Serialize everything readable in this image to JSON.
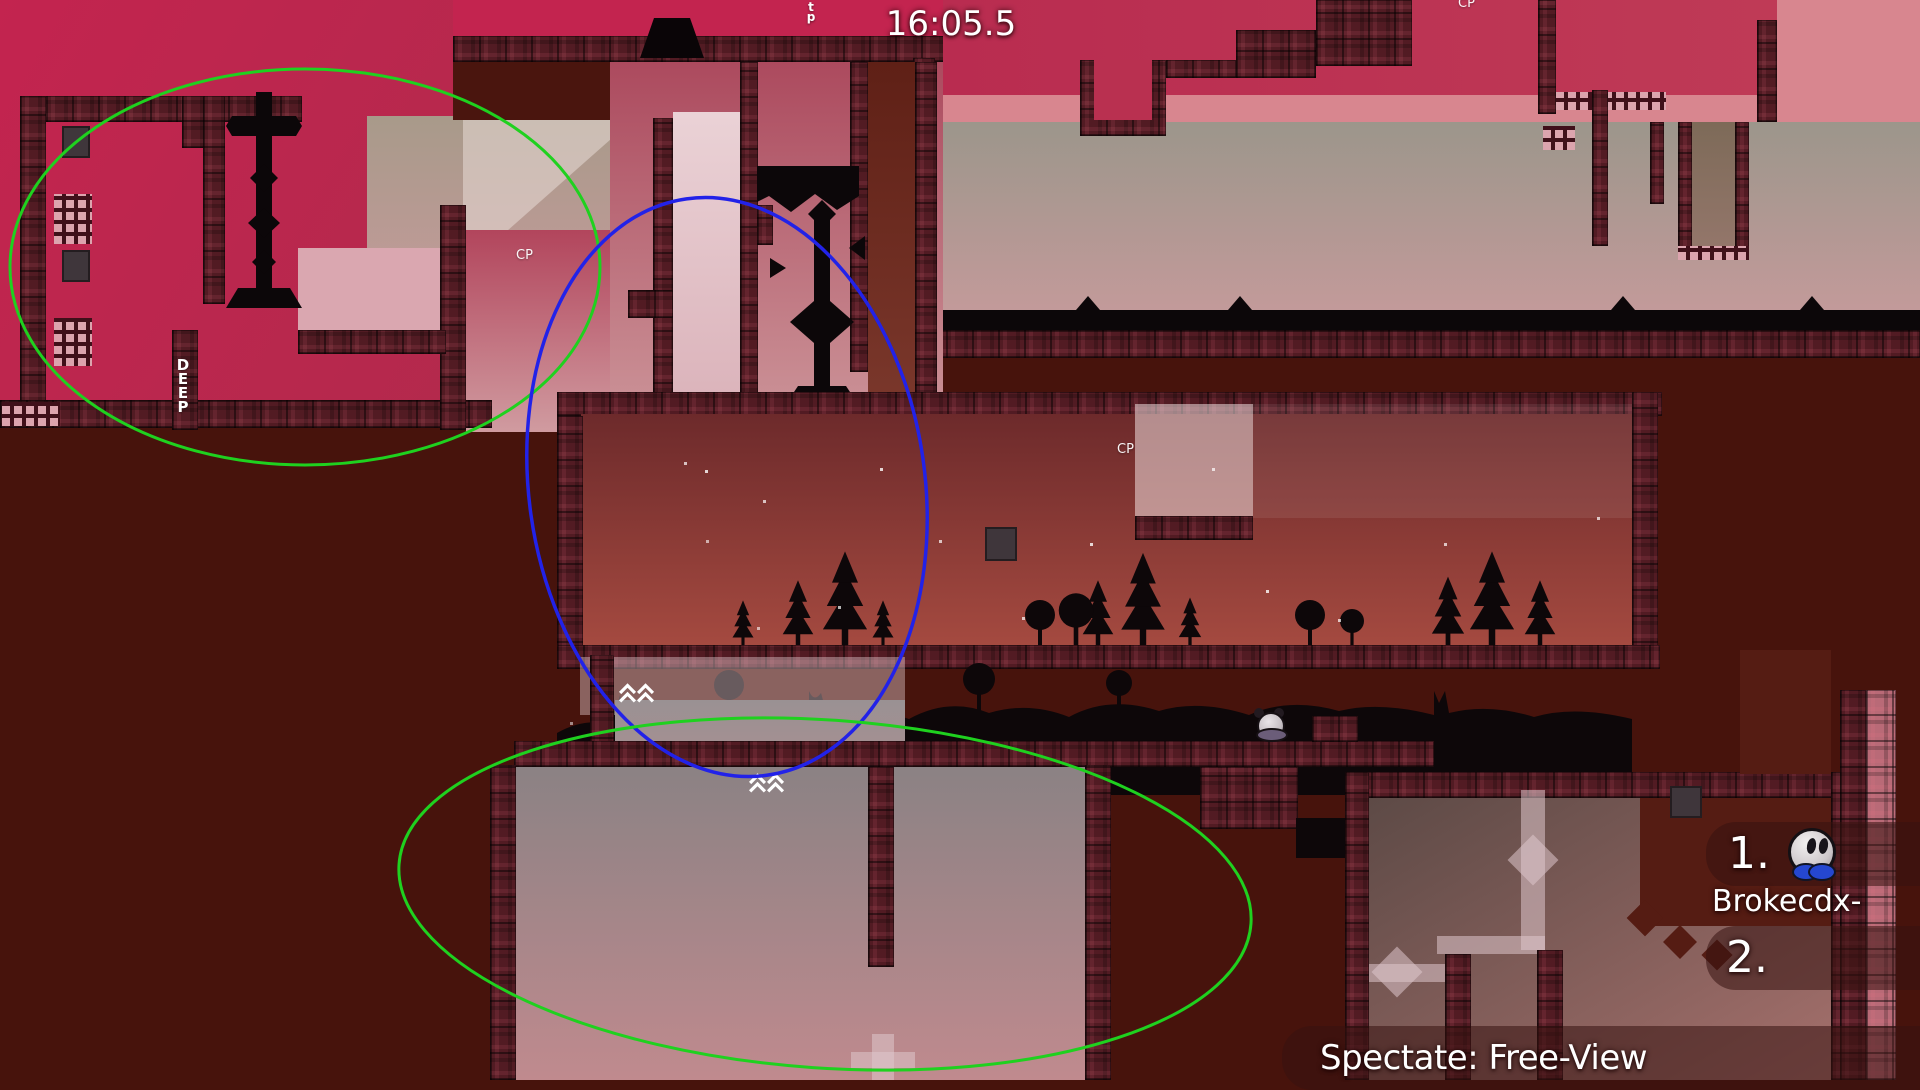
{
  "hud": {
    "timer": "16:05.5",
    "spectate_label": "Spectate: Free-View",
    "scoreboard": {
      "entries": [
        {
          "rank": "1.",
          "name": "Brokecdx-",
          "skin": "white-tee-blue-feet"
        },
        {
          "rank": "2.",
          "name": ""
        }
      ]
    }
  },
  "map": {
    "checkpoint_label": "CP",
    "deep_label": "DEEP",
    "teleport_label": "tp",
    "markers": {
      "speedup": "double-chevron-up",
      "speedup_count": 2
    },
    "visible_players": [
      {
        "skin": "panda-tee",
        "location": "ledge-mid-right"
      }
    ]
  },
  "annotations": {
    "ellipses": [
      {
        "color": "#1fd11f",
        "shape": "ellipse",
        "area": "top-left"
      },
      {
        "color": "#2222e8",
        "shape": "ellipse",
        "area": "center"
      },
      {
        "color": "#1fd11f",
        "shape": "ellipse",
        "area": "bottom-center"
      }
    ]
  },
  "colors": {
    "background": "#47130c",
    "crimson_zone": "#c3244f",
    "pink_band": "#d8868f",
    "sunset_sky_top": "#6d2a2b",
    "sunset_sky_bottom": "#a54a40",
    "hud_panel": "rgba(55,18,16,0.55)",
    "ellipse_green": "#1fd11f",
    "ellipse_blue": "#2222e8"
  }
}
